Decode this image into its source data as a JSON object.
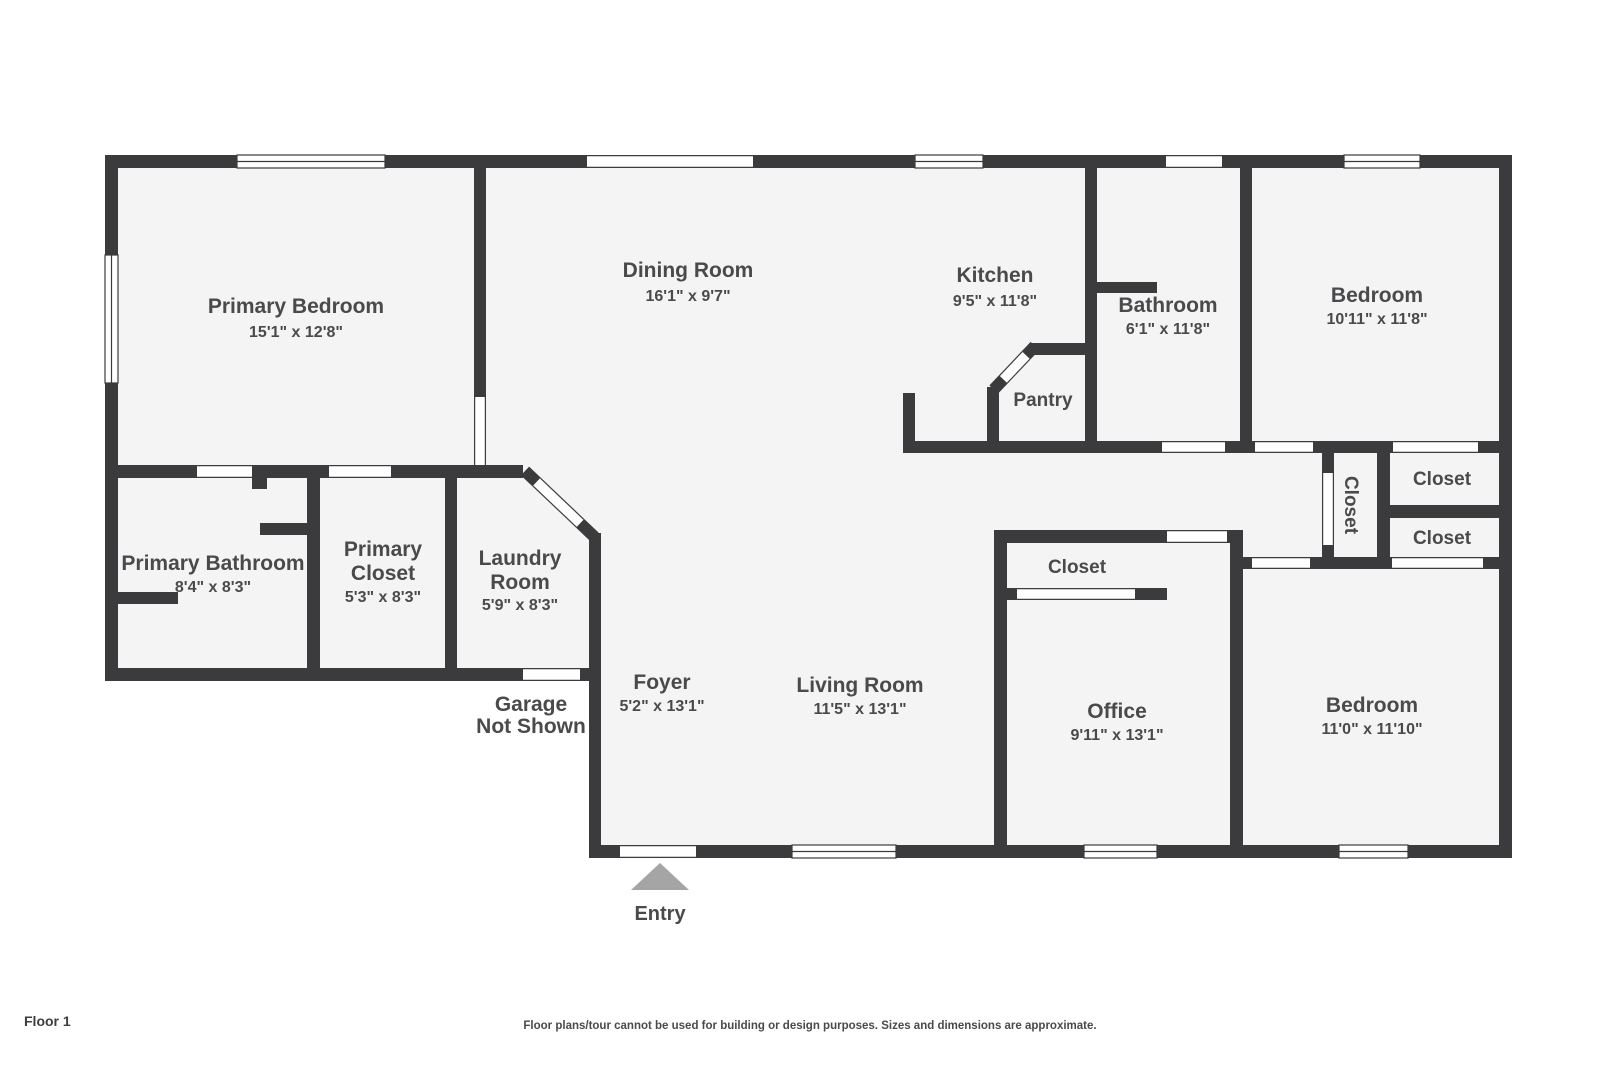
{
  "page": {
    "floor_label": "Floor 1",
    "disclaimer": "Floor plans/tour cannot be used for building or design purposes. Sizes and dimensions are approximate.",
    "entry_label": "Entry",
    "garage_note_line1": "Garage",
    "garage_note_line2": "Not Shown"
  },
  "rooms": {
    "primary_bedroom": {
      "name": "Primary Bedroom",
      "dims": "15'1\" x 12'8\""
    },
    "dining_room": {
      "name": "Dining Room",
      "dims": "16'1\" x 9'7\""
    },
    "kitchen": {
      "name": "Kitchen",
      "dims": "9'5\" x 11'8\""
    },
    "pantry": {
      "name": "Pantry"
    },
    "bathroom": {
      "name": "Bathroom",
      "dims": "6'1\" x 11'8\""
    },
    "bedroom_top_right": {
      "name": "Bedroom",
      "dims": "10'11\" x 11'8\""
    },
    "primary_bathroom": {
      "name": "Primary Bathroom",
      "dims": "8'4\" x 8'3\""
    },
    "primary_closet": {
      "name_line1": "Primary",
      "name_line2": "Closet",
      "dims": "5'3\" x 8'3\""
    },
    "laundry_room": {
      "name_line1": "Laundry",
      "name_line2": "Room",
      "dims": "5'9\" x 8'3\""
    },
    "foyer": {
      "name": "Foyer",
      "dims": "5'2\" x 13'1\""
    },
    "living_room": {
      "name": "Living Room",
      "dims": "11'5\" x 13'1\""
    },
    "office": {
      "name": "Office",
      "dims": "9'11\" x 13'1\""
    },
    "bedroom_bottom_right": {
      "name": "Bedroom",
      "dims": "11'0\" x 11'10\""
    },
    "office_closet": {
      "name": "Closet"
    },
    "hall_closet": {
      "name": "Closet"
    },
    "bedroom_closet_upper": {
      "name": "Closet"
    },
    "bedroom_closet_lower": {
      "name": "Closet"
    }
  },
  "colors": {
    "wall": "#3b3b3d",
    "room-fill": "#f4f4f4",
    "label": "#4a4a4c",
    "entry-arrow": "#a5a5a5",
    "page-bg": "#ffffff"
  }
}
